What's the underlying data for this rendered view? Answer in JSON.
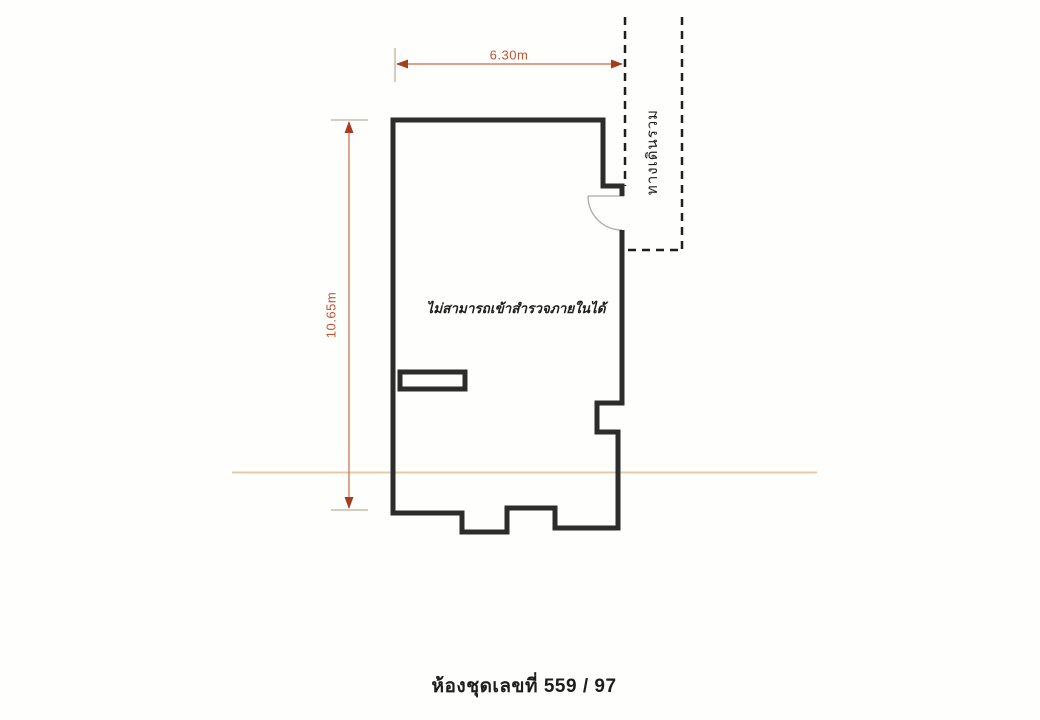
{
  "drawing": {
    "type": "floor-plan",
    "dimensions": {
      "width_label": "6.30m",
      "height_label": "10.65m"
    },
    "labels": {
      "corridor": "ทางเดินรวม",
      "interior_note": "ไม่สามารถเข้าสำรวจภายในได้",
      "caption": "ห้องชุดเลขที่ 559 / 97"
    },
    "colors": {
      "wall": "#2c2c2a",
      "dashed": "#1e1e1e",
      "dim_line": "#cc6a44",
      "arrowhead": "#a63b20",
      "tick": "#ccbcaa",
      "reference_line": "#e8c9a6",
      "door": "#a9a9a6",
      "background": "#fefefc"
    }
  }
}
